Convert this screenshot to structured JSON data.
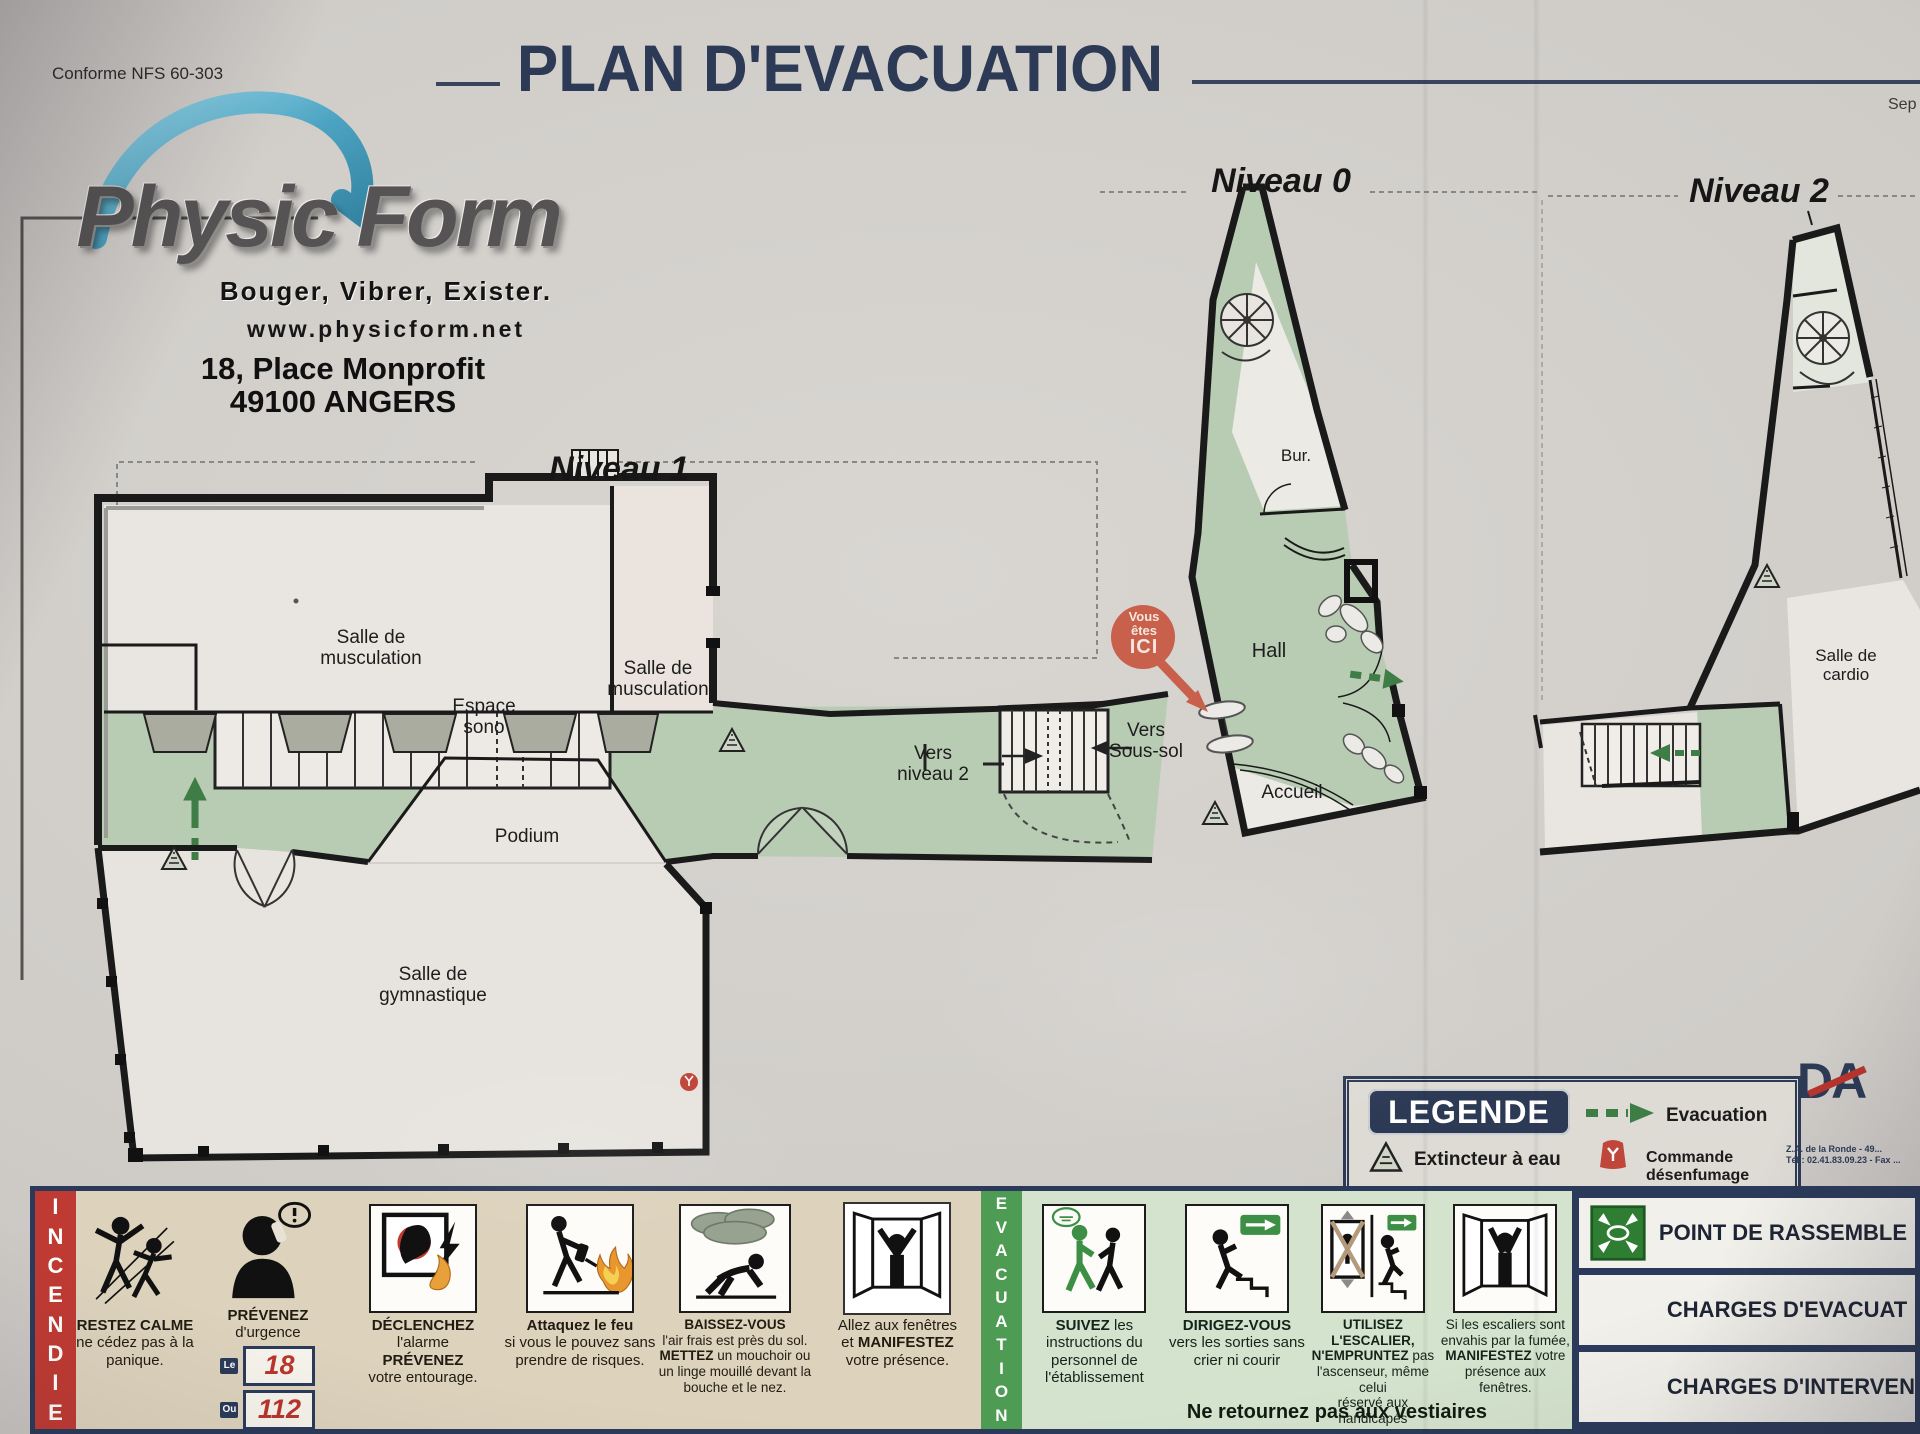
{
  "colors": {
    "navy": "#2c3a56",
    "red_strip": "#bf3a33",
    "green_strip": "#4e9b53",
    "plan_green": "#b8cbb3",
    "marker_red": "#c8604b",
    "arrow_green": "#3f7d46",
    "number_red": "#b8352c"
  },
  "header": {
    "conforme": "Conforme NFS 60-303",
    "title": "PLAN D'EVACUATION",
    "date_fragment": "Sep"
  },
  "logo": {
    "brand": "Physic Form",
    "tagline": "Bouger, Vibrer, Exister.",
    "website": "www.physicform.net",
    "address_line1": "18, Place Monprofit",
    "address_line2": "49100 ANGERS"
  },
  "levels": {
    "n1": "Niveau 1",
    "n0": "Niveau 0",
    "n2": "Niveau 2"
  },
  "plan": {
    "n1": {
      "musculation1_a": "Salle de",
      "musculation1_b": "musculation",
      "musculation2_a": "Salle de",
      "musculation2_b": "musculation",
      "espace_a": "Espace",
      "espace_b": "sono",
      "podium": "Podium",
      "gym_a": "Salle de",
      "gym_b": "gymnastique",
      "vers_n2_a": "Vers",
      "vers_n2_b": "niveau 2",
      "vers_ss_a": "Vers",
      "vers_ss_b": "Sous-sol"
    },
    "n0": {
      "bureau": "Bur.",
      "hall": "Hall",
      "accueil": "Accueil"
    },
    "n2": {
      "cardio_a": "Salle de",
      "cardio_b": "cardio"
    },
    "marker": {
      "l1": "Vous",
      "l2": "êtes",
      "l3": "ICI"
    }
  },
  "legend": {
    "title": "LEGENDE",
    "extincteur": "Extincteur à eau",
    "evacuation": "Evacuation",
    "desenfumage": "Commande désenfumage"
  },
  "vendor": {
    "name": "DA",
    "line1": "Z.A. de la Ronde - 49...",
    "line2": "Tél : 02.41.83.09.23 - Fax ..."
  },
  "incendie": {
    "strip": "INCENDIE",
    "p1_bold": "RESTEZ CALME",
    "p1_rest": "ne cédez pas à la panique.",
    "p2_bold": "PRÉVENEZ",
    "p2_rest": "d'urgence",
    "p2_le": "Le",
    "p2_n1": "18",
    "p2_ou": "Ou",
    "p2_n2": "112",
    "p3_b1": "DÉCLENCHEZ",
    "p3_r1": "l'alarme",
    "p3_b2": "PRÉVENEZ",
    "p3_r2": "votre entourage.",
    "p4_bold": "Attaquez le feu",
    "p4_rest": "si vous le pouvez sans prendre de risques.",
    "p5_b1": "BAISSEZ-VOUS",
    "p5_r1": "l'air frais est près du sol.",
    "p5_b2": "METTEZ",
    "p5_r2": " un mouchoir ou un linge mouillé devant la bouche et le nez.",
    "p6_r1": "Allez aux fenêtres",
    "p6_r2": "et ",
    "p6_b": "MANIFESTEZ",
    "p6_r3": "votre présence."
  },
  "evacuation": {
    "strip": "EVACUATION",
    "p7_bold": "SUIVEZ",
    "p7_rest": " les instructions du personnel de l'établissement",
    "p8_bold": "DIRIGEZ-VOUS",
    "p8_rest": " vers les sorties sans crier ni courir",
    "p9_b1": "UTILISEZ L'ESCALIER,",
    "p9_b2": "N'EMPRUNTEZ",
    "p9_r1": " pas",
    "p9_r2": "l'ascenseur, même celui",
    "p9_r3": "réservé aux handicapés",
    "p10_r1": "Si les escaliers sont",
    "p10_r2": "envahis par la fumée,",
    "p10_b": "MANIFESTEZ",
    "p10_r3": " votre",
    "p10_r4": "présence aux fenêtres.",
    "footer": "Ne retournez pas aux vestiaires"
  },
  "right_boxes": {
    "b1": "POINT DE RASSEMBLE",
    "b2": "CHARGES D'EVACUAT",
    "b3": "CHARGES D'INTERVEN"
  }
}
